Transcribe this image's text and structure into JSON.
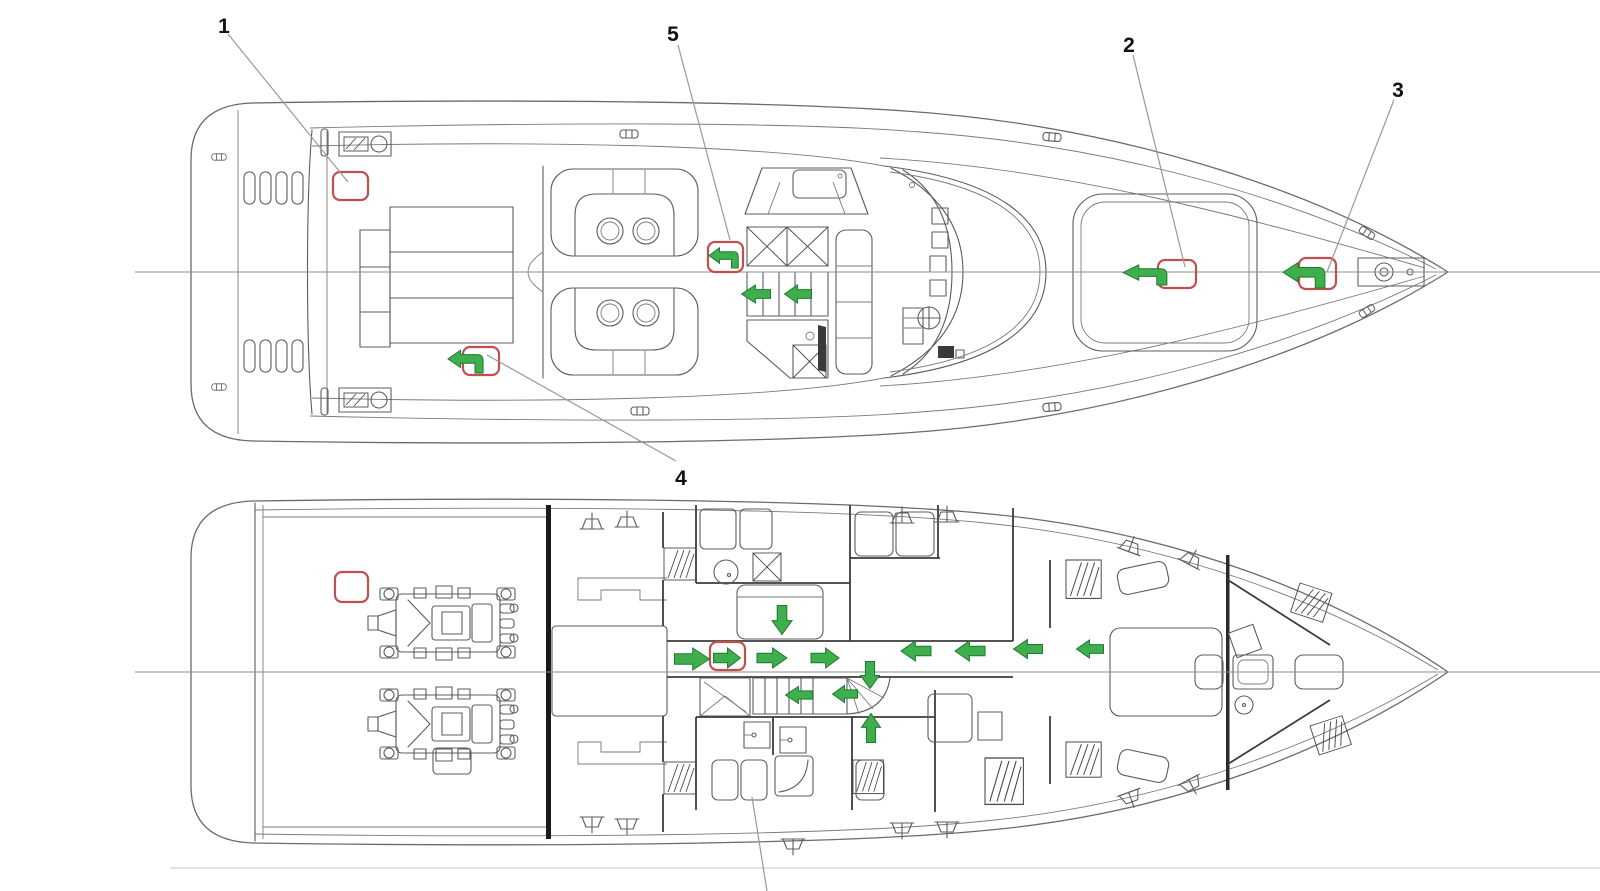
{
  "diagram": {
    "description": "Yacht general-arrangement escape-route plan, two deck views (main deck above, lower deck below)",
    "colors": {
      "annotation_red": "#c0504d",
      "arrow_green": "#3fae4c",
      "arrow_green_edge": "#1f7a2e",
      "line": "#5c5c5c",
      "centerline": "#8c8c8c",
      "leader": "#999999",
      "bulkhead": "#1a1a1a",
      "faint_bottom_line": "#d9d9d9"
    },
    "callouts": [
      {
        "label": "1",
        "x": 224,
        "y": 25,
        "leader": [
          [
            228,
            34
          ],
          [
            348,
            182
          ]
        ]
      },
      {
        "label": "5",
        "x": 673,
        "y": 33,
        "leader": [
          [
            678,
            45
          ],
          [
            730,
            240
          ]
        ]
      },
      {
        "label": "2",
        "x": 1129,
        "y": 44,
        "leader": [
          [
            1133,
            55
          ],
          [
            1185,
            267
          ]
        ]
      },
      {
        "label": "3",
        "x": 1398,
        "y": 89,
        "leader": [
          [
            1394,
            100
          ],
          [
            1327,
            272
          ]
        ]
      },
      {
        "label": "4",
        "x": 681,
        "y": 477,
        "leader": [
          [
            487,
            355
          ],
          [
            676,
            461
          ]
        ]
      }
    ],
    "extra_leaders": [
      {
        "name": "cutoff-callout-leader",
        "from": [
          752,
          797
        ],
        "to": [
          767,
          891
        ]
      }
    ],
    "red_boxes": [
      {
        "id": "main-deck-aft",
        "x": 333,
        "y": 172,
        "w": 35,
        "h": 28
      },
      {
        "id": "main-deck-port-aft",
        "x": 463,
        "y": 347,
        "w": 36,
        "h": 28
      },
      {
        "id": "salon",
        "x": 708,
        "y": 242,
        "w": 35,
        "h": 30
      },
      {
        "id": "foredeck",
        "x": 1158,
        "y": 260,
        "w": 38,
        "h": 28
      },
      {
        "id": "bow",
        "x": 1299,
        "y": 258,
        "w": 37,
        "h": 31
      },
      {
        "id": "engine-room",
        "x": 335,
        "y": 572,
        "w": 33,
        "h": 30
      },
      {
        "id": "corridor",
        "x": 710,
        "y": 642,
        "w": 35,
        "h": 28
      }
    ],
    "turn_arrows": [
      {
        "id": "turn-port-aft",
        "x": 448,
        "y": 347,
        "w": 36,
        "h": 26
      },
      {
        "id": "turn-salon",
        "x": 709,
        "y": 245,
        "w": 30,
        "h": 23
      },
      {
        "id": "turn-foredeck",
        "x": 1123,
        "y": 262,
        "w": 45,
        "h": 23
      },
      {
        "id": "turn-bow",
        "x": 1283,
        "y": 259,
        "w": 43,
        "h": 29
      }
    ],
    "route_arrows": [
      {
        "cx": 692,
        "cy": 659,
        "dir": "right",
        "len": 35,
        "girth": 22
      },
      {
        "cx": 727,
        "cy": 658,
        "dir": "right",
        "len": 27,
        "girth": 20
      },
      {
        "cx": 772,
        "cy": 658,
        "dir": "right",
        "len": 30,
        "girth": 20
      },
      {
        "cx": 825,
        "cy": 658,
        "dir": "right",
        "len": 28,
        "girth": 20
      },
      {
        "cx": 916,
        "cy": 651,
        "dir": "left",
        "len": 30,
        "girth": 20
      },
      {
        "cx": 970,
        "cy": 651,
        "dir": "left",
        "len": 30,
        "girth": 20
      },
      {
        "cx": 1028,
        "cy": 649,
        "dir": "left",
        "len": 29,
        "girth": 19
      },
      {
        "cx": 1090,
        "cy": 649,
        "dir": "left",
        "len": 27,
        "girth": 18
      },
      {
        "cx": 782,
        "cy": 620,
        "dir": "down",
        "len": 29,
        "girth": 20
      },
      {
        "cx": 870,
        "cy": 675,
        "dir": "down",
        "len": 27,
        "girth": 19
      },
      {
        "cx": 799,
        "cy": 695,
        "dir": "left",
        "len": 27,
        "girth": 17
      },
      {
        "cx": 845,
        "cy": 694,
        "dir": "left",
        "len": 25,
        "girth": 17
      },
      {
        "cx": 871,
        "cy": 728,
        "dir": "up",
        "len": 29,
        "girth": 19
      },
      {
        "cx": 756,
        "cy": 294,
        "dir": "left",
        "len": 29,
        "girth": 18
      },
      {
        "cx": 798,
        "cy": 294,
        "dir": "left",
        "len": 27,
        "girth": 18
      }
    ],
    "centerlines": [
      {
        "id": "main-deck-centerline",
        "x1": 135,
        "y1": 272,
        "x2": 1600,
        "y2": 272
      },
      {
        "id": "lower-deck-centerline",
        "x1": 135,
        "y1": 672,
        "x2": 1600,
        "y2": 672
      }
    ],
    "faint_bottom_line": {
      "x1": 170,
      "y1": 868,
      "x2": 1600,
      "y2": 868
    }
  }
}
